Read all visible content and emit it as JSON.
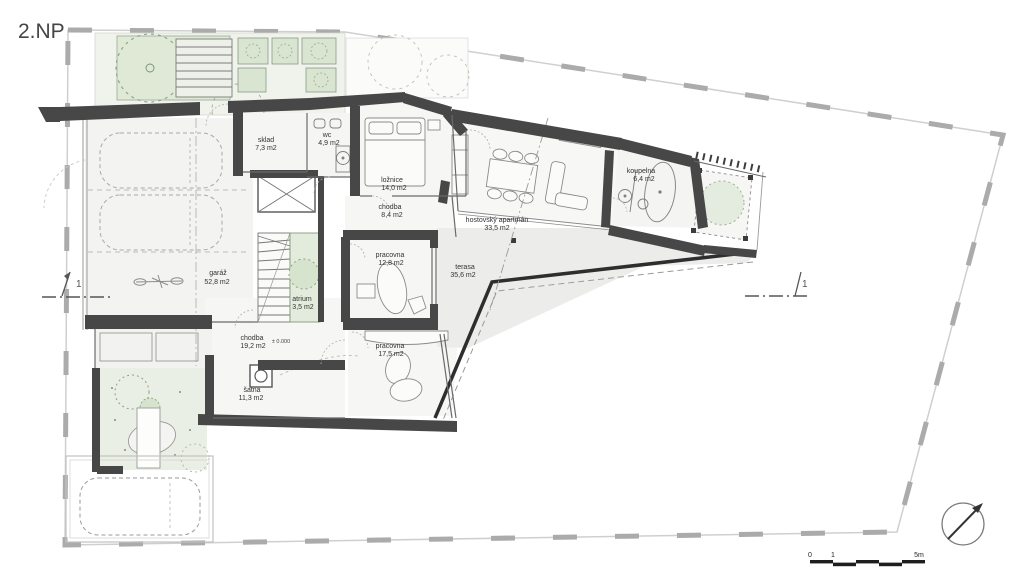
{
  "title": "2.NP",
  "rooms": [
    {
      "name": "sklad",
      "area": "7,3 m2"
    },
    {
      "name": "wc",
      "area": "4,9 m2"
    },
    {
      "name": "ložnice",
      "area": "14,0 m2"
    },
    {
      "name": "chodba",
      "area": "8,4 m2"
    },
    {
      "name": "hostovský apartmán",
      "area": "33,5 m2"
    },
    {
      "name": "koupelna",
      "area": "6,4 m2"
    },
    {
      "name": "garáž",
      "area": "52,8 m2"
    },
    {
      "name": "atrium",
      "area": "3,5 m2"
    },
    {
      "name": "pracovna",
      "area": "12,8 m2"
    },
    {
      "name": "terasa",
      "area": "35,6 m2"
    },
    {
      "name": "chodba",
      "area": "19,2 m2"
    },
    {
      "name": "pracovna",
      "area": "17,5 m2"
    },
    {
      "name": "šatna",
      "area": "11,3 m2"
    }
  ],
  "annotations": {
    "level_mark": "± 0.000",
    "section_left": "1",
    "section_right": "1"
  },
  "scale_bar": {
    "start": "0",
    "one": "1",
    "end": "5m"
  },
  "colors": {
    "wall": "#474747",
    "thin_line": "#888888",
    "site_boundary": "#b3b3b3",
    "floor": "#f4f4f2",
    "terrace": "#ececea",
    "green": "#e4ecdd",
    "green_dark": "#d7e4cd"
  }
}
